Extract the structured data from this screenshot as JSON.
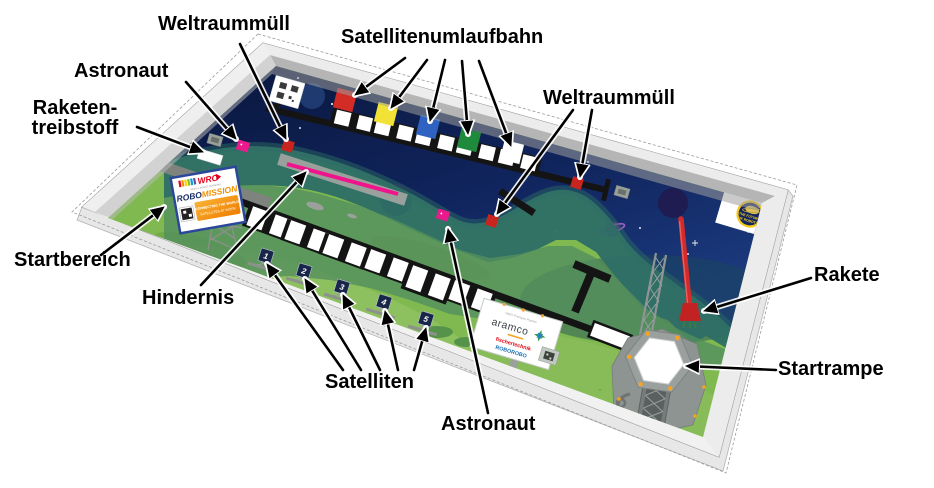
{
  "labels": {
    "weltraummuell_top": "Weltraummüll",
    "satellitenumlaufbahn": "Satellitenumlaufbahn",
    "astronaut_top": "Astronaut",
    "raketentreibstoff_line1": "Raketen-",
    "raketentreibstoff_line2": "treibstoff",
    "startbereich": "Startbereich",
    "hindernis": "Hindernis",
    "satelliten": "Satelliten",
    "astronaut_bottom": "Astronaut",
    "weltraummuell_right": "Weltraummüll",
    "rakete": "Rakete",
    "startrampe": "Startrampe"
  },
  "mat": {
    "start_card": {
      "wro": "WRO",
      "wro_sub": "WORLD ROBOT OLYMPIAD",
      "robo": "ROBO",
      "mission": "MISSION",
      "box_line1": "CONNECTING THE WORLD",
      "box_line2": "SATELLITES AT WORK"
    },
    "sponsor_board": {
      "partner": "WRO Premium Partner",
      "brand": "aramco",
      "line2": "fischertechnik",
      "line3": "ROBOROBO"
    },
    "season_logo": {
      "line1": "THE FUTURE",
      "line2": "OF ROBOTS"
    },
    "satellite_numbers": [
      "1",
      "2",
      "3",
      "4",
      "5"
    ]
  },
  "colors": {
    "space_navy": "#0d1d4a",
    "grass_green": "#7fb950",
    "track_black": "#141414",
    "orbit_red": "#d32b25",
    "orbit_yellow": "#f2e235",
    "orbit_blue": "#2f62c1",
    "orbit_green": "#1f8a3c",
    "orbit_white": "#ffffff",
    "debris_red": "#c9251f",
    "astronaut_pink": "#ea1a8c",
    "obstacle_pink": "#f0148c",
    "rocket_red": "#d32b2b",
    "pad_orange": "#f6a41f",
    "frame_white": "#f4f4f4"
  }
}
